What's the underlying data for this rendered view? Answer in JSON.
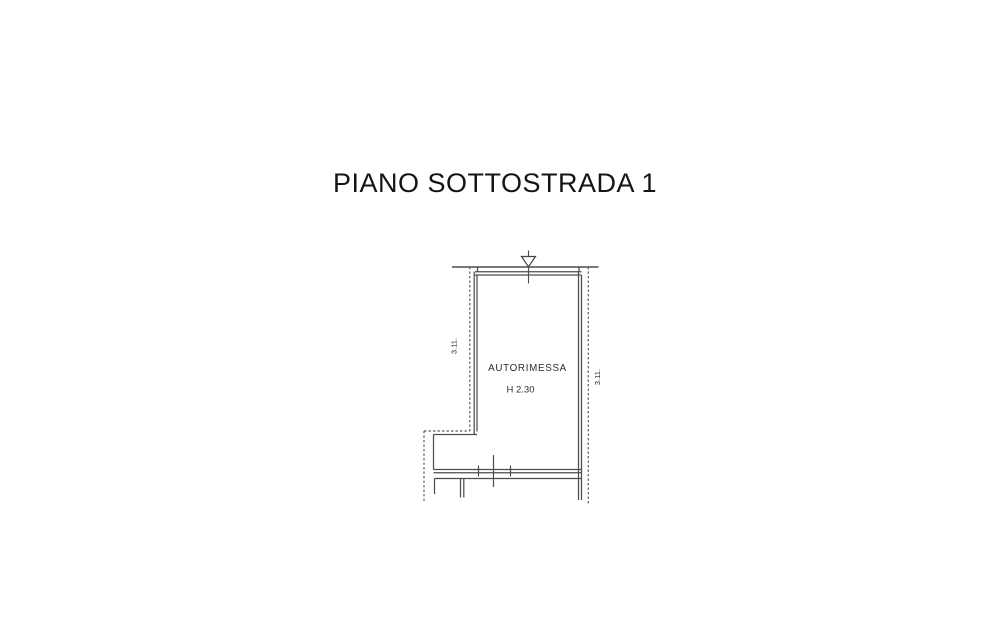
{
  "title": "PIANO SOTTOSTRADA 1",
  "plan": {
    "room_label": "AUTORIMESSA",
    "height_label": "H 2.30",
    "dim_left": "3.11.",
    "dim_right": "3.11.",
    "line_color": "#4d4d4d",
    "dashed_color": "#585858",
    "background": "#ffffff"
  }
}
